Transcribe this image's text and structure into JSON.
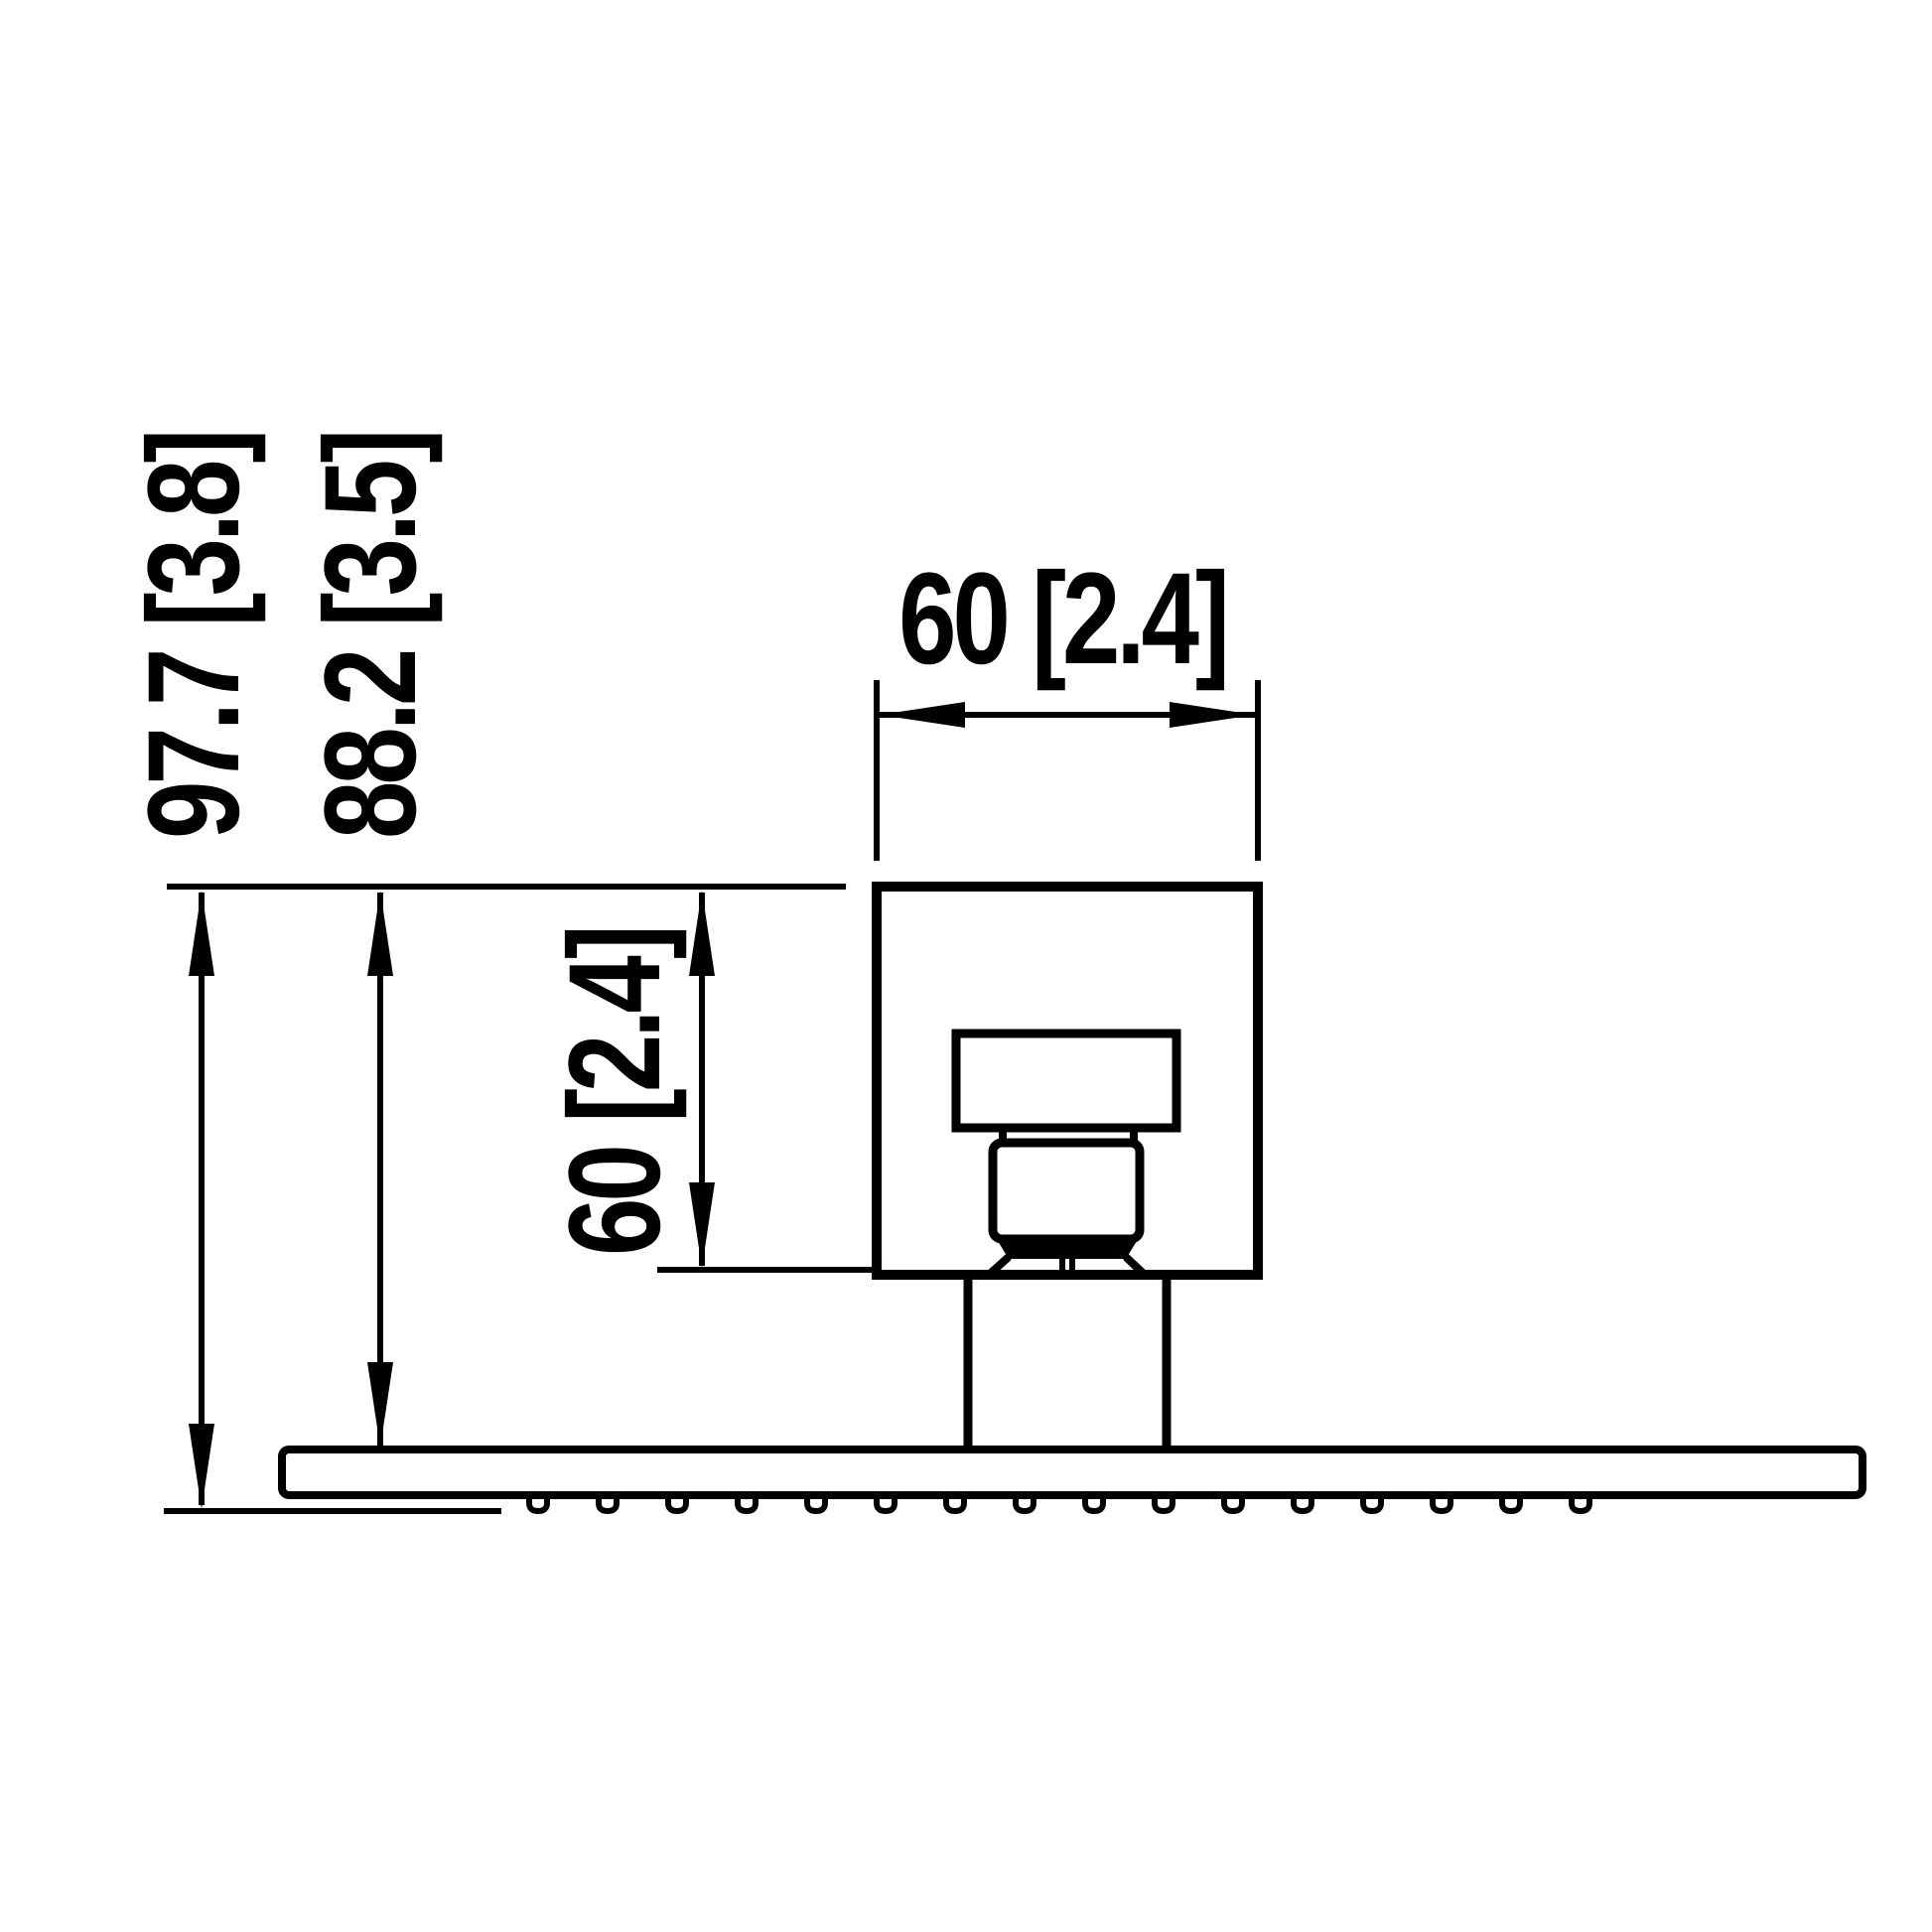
{
  "drawing": {
    "background": "#ffffff",
    "line_color": "#000000",
    "labels": {
      "total_height": "97.7 [3.8]",
      "height_to_plate": "88.2 [3.5]",
      "mount_width": "60 [2.4]",
      "mount_height": "60 [2.4]"
    },
    "nozzle_count": 16
  }
}
